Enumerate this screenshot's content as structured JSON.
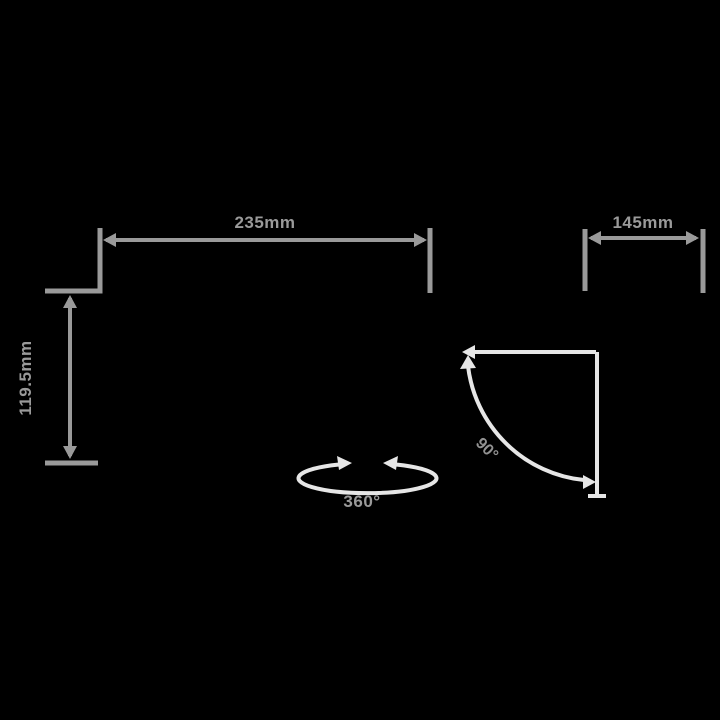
{
  "diagram": {
    "type": "product-dimension-diagram",
    "colors": {
      "background": "#000000",
      "dimension_line": "#9a9a9a",
      "indicator_line": "#e6e6e6",
      "dimension_text": "#9a9a9a",
      "angle_text": "#929292"
    },
    "dimensions": {
      "width_label": "235mm",
      "height_label": "119.5mm",
      "depth_label": "145mm"
    },
    "angles": {
      "tilt_label": "90°",
      "rotation_label": "360°"
    },
    "icons": {
      "rotation_arrows": "circular-rotation-arrows",
      "tilt_arc": "quarter-circle-tilt-arc"
    }
  }
}
